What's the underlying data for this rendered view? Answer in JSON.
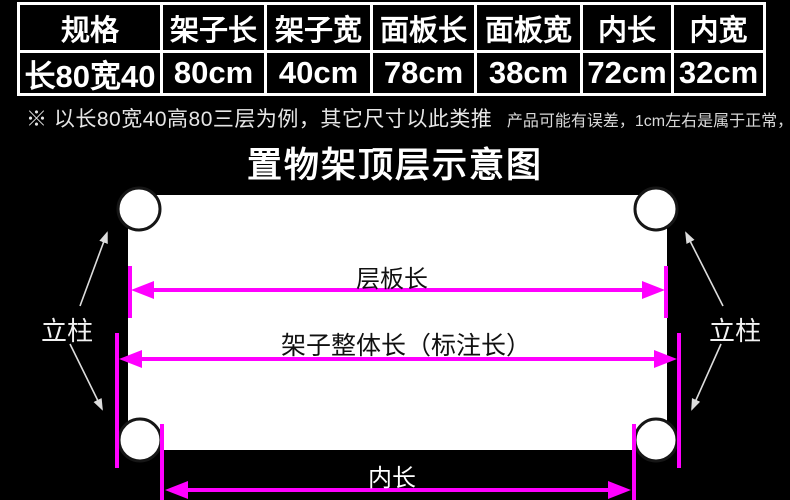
{
  "spec_table": {
    "columns": [
      {
        "header": "规格",
        "value": "长80宽40"
      },
      {
        "header": "架子长",
        "value": "80cm"
      },
      {
        "header": "架子宽",
        "value": "40cm"
      },
      {
        "header": "面板长",
        "value": "78cm"
      },
      {
        "header": "面板宽",
        "value": "38cm"
      },
      {
        "header": "内长",
        "value": "72cm"
      },
      {
        "header": "内宽",
        "value": "32cm"
      }
    ]
  },
  "note": {
    "main": "※ 以长80宽40高80三层为例，其它尺寸以此类推",
    "secondary": "产品可能有误差，1cm左右是属于正常，介意慎拍!"
  },
  "diagram": {
    "title": "置物架顶层示意图",
    "board_length_label": "层板长",
    "overall_length_label": "架子整体长（标注长）",
    "inner_length_label": "内长",
    "post_label_left": "立柱",
    "post_label_right": "立柱",
    "colors": {
      "background": "#000000",
      "panel": "#ffffff",
      "dimension_arrow": "#ff00ff",
      "table_border": "#ffffff",
      "pointer_arrow": "#dddddd"
    }
  }
}
